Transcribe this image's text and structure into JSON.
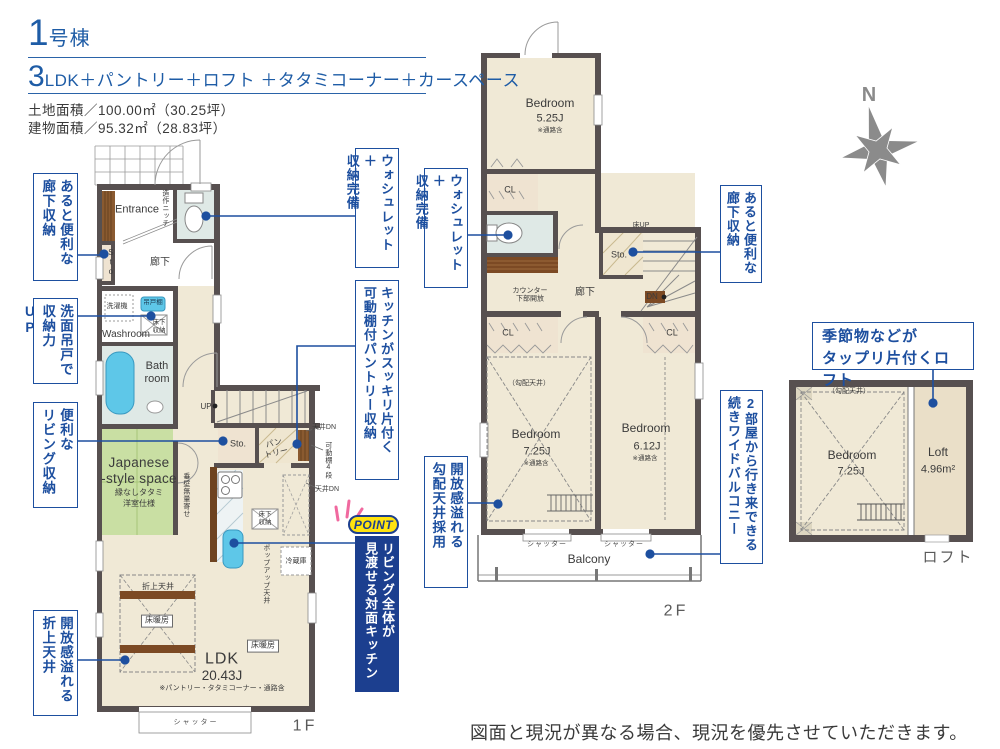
{
  "header": {
    "building_num": "1",
    "building_suffix": "号棟",
    "plan_num": "3",
    "plan_suffix": "LDK＋パントリー＋ロフト ＋タタミコーナー＋カースペース",
    "land_area": "土地面積／100.00㎡（30.25坪）",
    "building_area": "建物面積／95.32㎡（28.83坪）"
  },
  "compass": {
    "north": "N"
  },
  "floor1": {
    "label": "1F",
    "entrance": "Entrance",
    "niche": "造作ニッチ",
    "sto_hall": "Sto.",
    "hallway": "廊下",
    "washer": "洗濯機",
    "hanging_cabinet": "吊戸棚",
    "washroom": "Washroom",
    "underfloor_wash": "床下\n収納",
    "bathroom": "Bath\nroom",
    "up": "UP",
    "sto_mid": "Sto.",
    "pantry": "パン\nトリー",
    "ceiling_dn_top": "天井DN",
    "movable_shelf": "可動棚4段",
    "ceiling_dn_bottom": "天井DN",
    "japanese_space": "Japanese\n-style space",
    "tatami_note": "縁なしタタミ",
    "tatami_note2": "洋室仕様",
    "wall_note": "垂壁無量寄せ",
    "underfloor_kitchen": "床下\n収納",
    "popup_ceiling": "ポップアップ天井",
    "fridge": "冷蔵庫",
    "coffered_ceiling": "折上天井",
    "floor_heating_1": "床暖房",
    "floor_heating_2": "床暖房",
    "ldk": "LDK",
    "ldk_size": "20.43J",
    "ldk_note": "※パントリー・タタミコーナー・通路含",
    "shutter": "シャッター"
  },
  "floor2": {
    "label": "2F",
    "bedroom1": "Bedroom",
    "bedroom1_size": "5.25J",
    "bedroom1_note": "※通路含",
    "cl1": "CL",
    "cl2": "CL",
    "cl3": "CL",
    "floor_up": "床UP",
    "sto": "Sto.",
    "dn": "DN",
    "hallway": "廊下",
    "counter": "カウンター\n下部開放",
    "sloped_ceiling": "（勾配天井）",
    "bedroom2": "Bedroom",
    "bedroom2_size": "7.25J",
    "bedroom2_note": "※通路含",
    "bedroom3": "Bedroom",
    "bedroom3_size": "6.12J",
    "bedroom3_note": "※通路含",
    "shutter1": "シャッター",
    "shutter2": "シャッター",
    "balcony": "Balcony"
  },
  "loft": {
    "label": "ロフト",
    "sloped_ceiling": "（勾配天井）",
    "bedroom": "Bedroom",
    "bedroom_size": "7.25J",
    "loft": "Loft",
    "loft_size": "4.96m²"
  },
  "callouts": {
    "hall_storage_1f": {
      "line1": "あると便利な",
      "line2": "廊下収納"
    },
    "vanity": {
      "line1": "洗面吊戸で",
      "line2": "収納力UP"
    },
    "living_storage": {
      "line1": "便利な",
      "line2": "リビング収納"
    },
    "coffered": {
      "line1": "開放感溢れる",
      "line2": "折上天井"
    },
    "washlet_1f": {
      "line1": "ウォシュレット＋",
      "line2": "収納完備"
    },
    "pantry": {
      "line1": "キッチンがスッキリ片付く",
      "line2": "可動棚付パントリー収納"
    },
    "point": {
      "badge": "POINT",
      "line1": "リビング全体が",
      "line2": "見渡せる対面キッチン"
    },
    "washlet_2f": {
      "line1": "ウォシュレット＋",
      "line2": "収納完備"
    },
    "sloped": {
      "line1": "開放感溢れる",
      "line2": "勾配天井採用"
    },
    "hall_storage_2f": {
      "line1": "あると便利な",
      "line2": "廊下収納"
    },
    "balcony": {
      "line1": "2部屋から行き来できる",
      "line2": "続きワイドバルコニー"
    },
    "loft": {
      "line1": "季節物などが",
      "line2": "タップリ片付くロフト"
    }
  },
  "footer": {
    "disclaimer": "図面と現況が異なる場合、現況を優先させていただきます。"
  },
  "colors": {
    "accent_blue": "#1d4f9f",
    "point_navy": "#1c3f8f",
    "point_yellow": "#ffe30f",
    "wall": "#575050",
    "room_beige": "#f0e9d6",
    "wet_blue": "#dfe9e6",
    "water_cyan": "#5ec7e8",
    "tatami_green": "#c9dfa3",
    "wood_brown": "#8a5a30"
  }
}
